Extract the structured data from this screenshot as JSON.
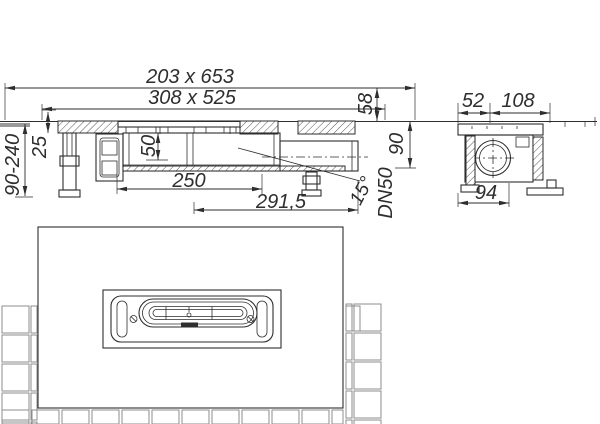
{
  "labels": {
    "overall_grate": "203 x 653",
    "cutout": "308 x 525",
    "edge_height": "58",
    "install_depth": "90",
    "adjust_height": "90-240",
    "flange_offset": "25",
    "water_seal": "50",
    "body_length": "250",
    "outlet_offset": "291,5",
    "outlet_angle": "15°",
    "outlet_size": "DN50",
    "side_offset_a": "52",
    "side_offset_b": "108",
    "side_foot_width": "94"
  },
  "colors": {
    "line": "#2e2e2e",
    "tile_line": "#8c8c8c",
    "screed": "#9a9a9a",
    "background": "#ffffff"
  }
}
